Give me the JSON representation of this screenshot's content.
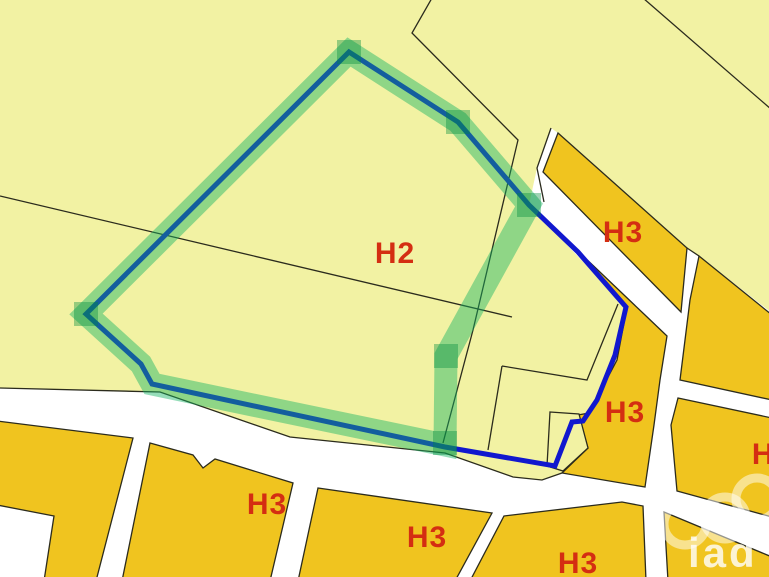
{
  "map": {
    "colors": {
      "zone_light": "#f2f2a3",
      "zone_gold": "#f0c41f",
      "road_white": "#ffffff",
      "boundary_line": "#2b2b1d",
      "label_red": "#d42e12",
      "selection_blue": "#1118ce",
      "highlight_green": "rgba(22,180,100,0.45)",
      "highlight_node_green": "rgba(0,140,60,0.38)",
      "watermark_white": "rgba(255,255,255,0.55)"
    },
    "zone_labels": [
      {
        "text": "H2",
        "x": "395",
        "y": "263"
      },
      {
        "text": "H3",
        "x": "623",
        "y": "242"
      },
      {
        "text": "H3",
        "x": "625",
        "y": "422"
      },
      {
        "text": "H3",
        "x": "267",
        "y": "514"
      },
      {
        "text": "H3",
        "x": "427",
        "y": "547"
      },
      {
        "text": "H3",
        "x": "578",
        "y": "573"
      },
      {
        "text": "H3",
        "x": "772",
        "y": "464"
      }
    ],
    "watermark": {
      "text": "iad"
    },
    "regions": {
      "zone_h2_main": {
        "points": "0,-3 772,-3 772,313 699,256 687,248 558,133 551,128 537,168 529,205 626,307 617,360 589,413 578,415 588,448 562,473 542,480 513,477 445,453 290,437 160,392 0,388"
      },
      "notch_parcel": {
        "points": "550,412 579,414 588,448 563,471 547,466"
      },
      "gold_parcels": [
        {
          "points": "558,133 687,248 681,312 543,172"
        },
        {
          "points": "580,253 645,315 667,336 660,380 654,425 645,487 562,473 588,448 578,415 589,413 617,360 627,307"
        },
        {
          "points": "699,256 772,315 772,400 680,380 690,300"
        },
        {
          "points": "678,398 772,418 772,517 677,491 671,425"
        },
        {
          "points": "-3,421 133,438 96,581 44,581 54,516 -3,505"
        },
        {
          "points": "150,443 193,455 203,468 215,459 293,483 270,581 122,581"
        },
        {
          "points": "318,488 492,513 455,581 298,581"
        },
        {
          "points": "504,516 622,502 643,506 646,581 470,581"
        },
        {
          "points": "664,512 772,557 772,581 668,581"
        }
      ]
    },
    "boundary_lines": [
      {
        "points": "0,196 512,317"
      },
      {
        "points": "432,-2 412,33 518,140 473,330 443,443"
      },
      {
        "points": "643,-2 772,110"
      },
      {
        "points": "502,366 587,380 618,304"
      },
      {
        "points": "502,366 488,450"
      },
      {
        "points": "551,128 537,168 544,202"
      },
      {
        "points": "0,388 160,392 290,437 445,453 513,477 542,480 562,473"
      },
      {
        "points": "687,248 699,256"
      }
    ],
    "selection": {
      "blue_outline_points": "349,52 458,122 529,205 578,252 626,307 615,355 597,400 585,418 583,421 572,422 555,466 445,447 152,384 141,364 86,314",
      "green_highlight_points": "86,314 349,52 458,122 529,205 446,356 445,445 152,384 141,364",
      "nodes": [
        {
          "x": "337",
          "y": "40"
        },
        {
          "x": "446",
          "y": "110"
        },
        {
          "x": "517",
          "y": "193"
        },
        {
          "x": "434",
          "y": "344"
        },
        {
          "x": "433",
          "y": "431"
        },
        {
          "x": "74",
          "y": "302"
        }
      ]
    },
    "watermark_rings": [
      {
        "cx": "685",
        "cy": "524"
      },
      {
        "cx": "725",
        "cy": "518"
      },
      {
        "cx": "757",
        "cy": "499"
      }
    ]
  }
}
